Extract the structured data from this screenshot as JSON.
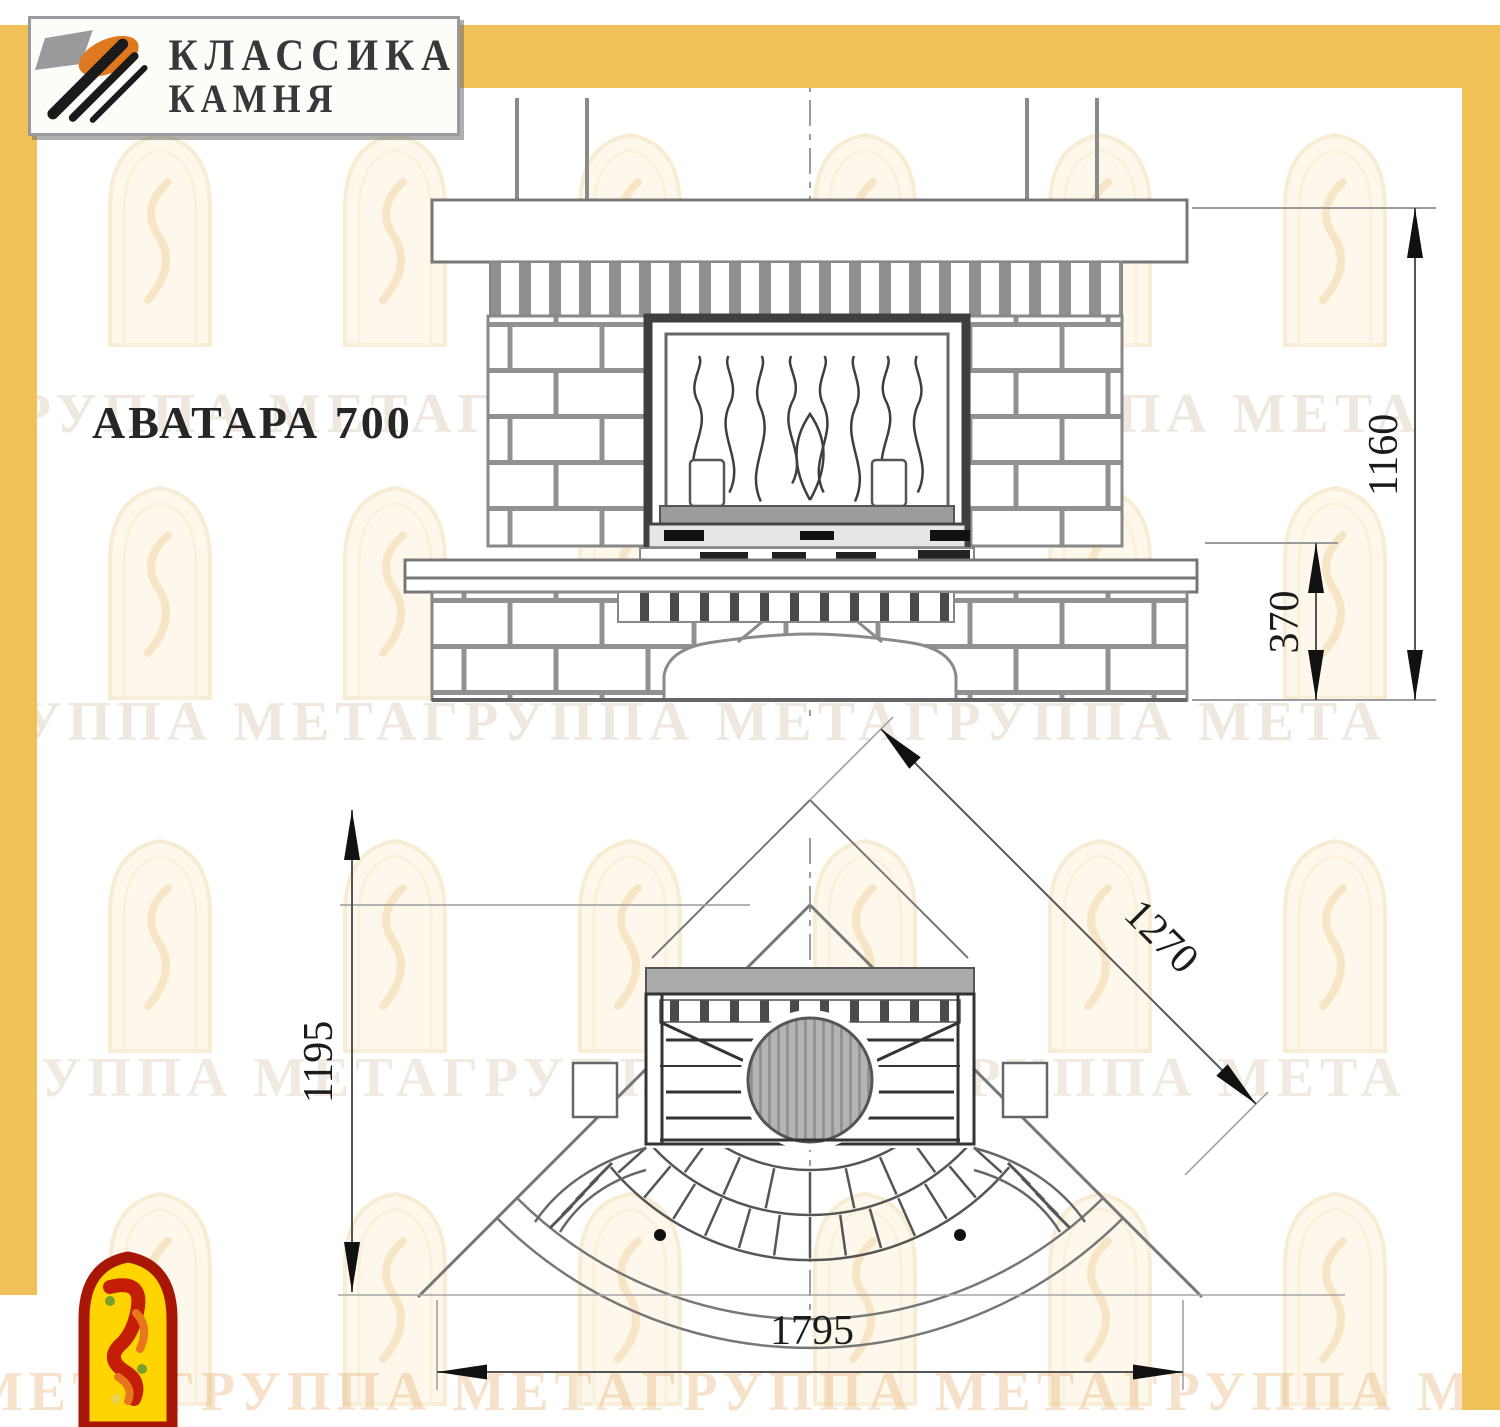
{
  "brand": {
    "name_line1": "КЛАССИКА",
    "name_line2": "КАМНЯ"
  },
  "title": "АВАТАРА 700",
  "watermark": {
    "band_text": "ГРУППА МЕТАГРУППА МЕТАГРУППА МЕТА",
    "band_text_bottom": "МЕТАГРУППА МЕТАГРУППА МЕТАГРУППА М"
  },
  "front_view": {
    "label_height": "1160",
    "label_hearth": "370"
  },
  "plan_view": {
    "label_depth": "1195",
    "label_diagonal": "1270",
    "label_width": "1795"
  },
  "colors": {
    "frame_yellow": "#F0C156",
    "logo_orange": "#E07820",
    "logo_gray": "#9a9a9a",
    "meta_red": "#A81605",
    "meta_yellow": "#FFD400",
    "line_gray": "#777777",
    "dark_frame": "#3f3f3f"
  }
}
